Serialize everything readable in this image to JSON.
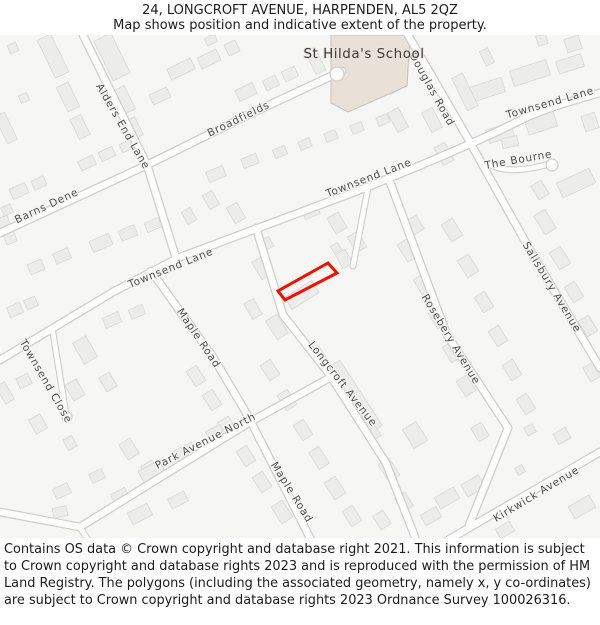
{
  "header": {
    "title": "24, LONGCROFT AVENUE, HARPENDEN, AL5 2QZ",
    "subtitle": "Map shows position and indicative extent of the property."
  },
  "map": {
    "school_label": {
      "name": "St Hilda's School",
      "x": 364,
      "y": 58
    },
    "street_labels": [
      {
        "name": "Alders End Lane",
        "x": 120,
        "y": 128,
        "rot": 60
      },
      {
        "name": "Broadfields",
        "x": 240,
        "y": 122,
        "rot": -26
      },
      {
        "name": "Barns Dene",
        "x": 48,
        "y": 209,
        "rot": -25
      },
      {
        "name": "Douglas Road",
        "x": 429,
        "y": 91,
        "rot": 61
      },
      {
        "name": "Townsend Lane",
        "x": 551,
        "y": 106,
        "rot": -16
      },
      {
        "name": "Townsend Lane",
        "x": 370,
        "y": 181,
        "rot": -21
      },
      {
        "name": "Townsend Lane",
        "x": 172,
        "y": 271,
        "rot": -22
      },
      {
        "name": "The Bourne",
        "x": 519,
        "y": 163,
        "rot": -10
      },
      {
        "name": "Salisbury Avenue",
        "x": 549,
        "y": 289,
        "rot": 59
      },
      {
        "name": "Townsend Close",
        "x": 43,
        "y": 383,
        "rot": 60
      },
      {
        "name": "Maple Road",
        "x": 196,
        "y": 340,
        "rot": 56
      },
      {
        "name": "Longcroft Avenue",
        "x": 340,
        "y": 386,
        "rot": 52
      },
      {
        "name": "Rosebery Avenue",
        "x": 448,
        "y": 341,
        "rot": 59
      },
      {
        "name": "Park Avenue North",
        "x": 207,
        "y": 444,
        "rot": -27
      },
      {
        "name": "Maple Road",
        "x": 289,
        "y": 494,
        "rot": 58
      },
      {
        "name": "Kirkwick Avenue",
        "x": 538,
        "y": 497,
        "rot": -31
      }
    ],
    "colors": {
      "background": "#f6f6f4",
      "building_fill": "#ececea",
      "building_stroke": "#d8d8d6",
      "road_fill": "#fdfdfd",
      "road_casing": "#cfcecc",
      "school_fill": "#e9e0d7",
      "school_stroke": "#c9c0b5",
      "property_outline": "#ee1100",
      "street_label_color": "#4f4f4f"
    }
  },
  "footer": {
    "copyright": "Contains OS data © Crown copyright and database right 2021. This information is subject to Crown copyright and database rights 2023 and is reproduced with the permission of HM Land Registry. The polygons (including the associated geometry, namely x, y co-ordinates) are subject to Crown copyright and database rights 2023 Ordnance Survey 100026316."
  }
}
